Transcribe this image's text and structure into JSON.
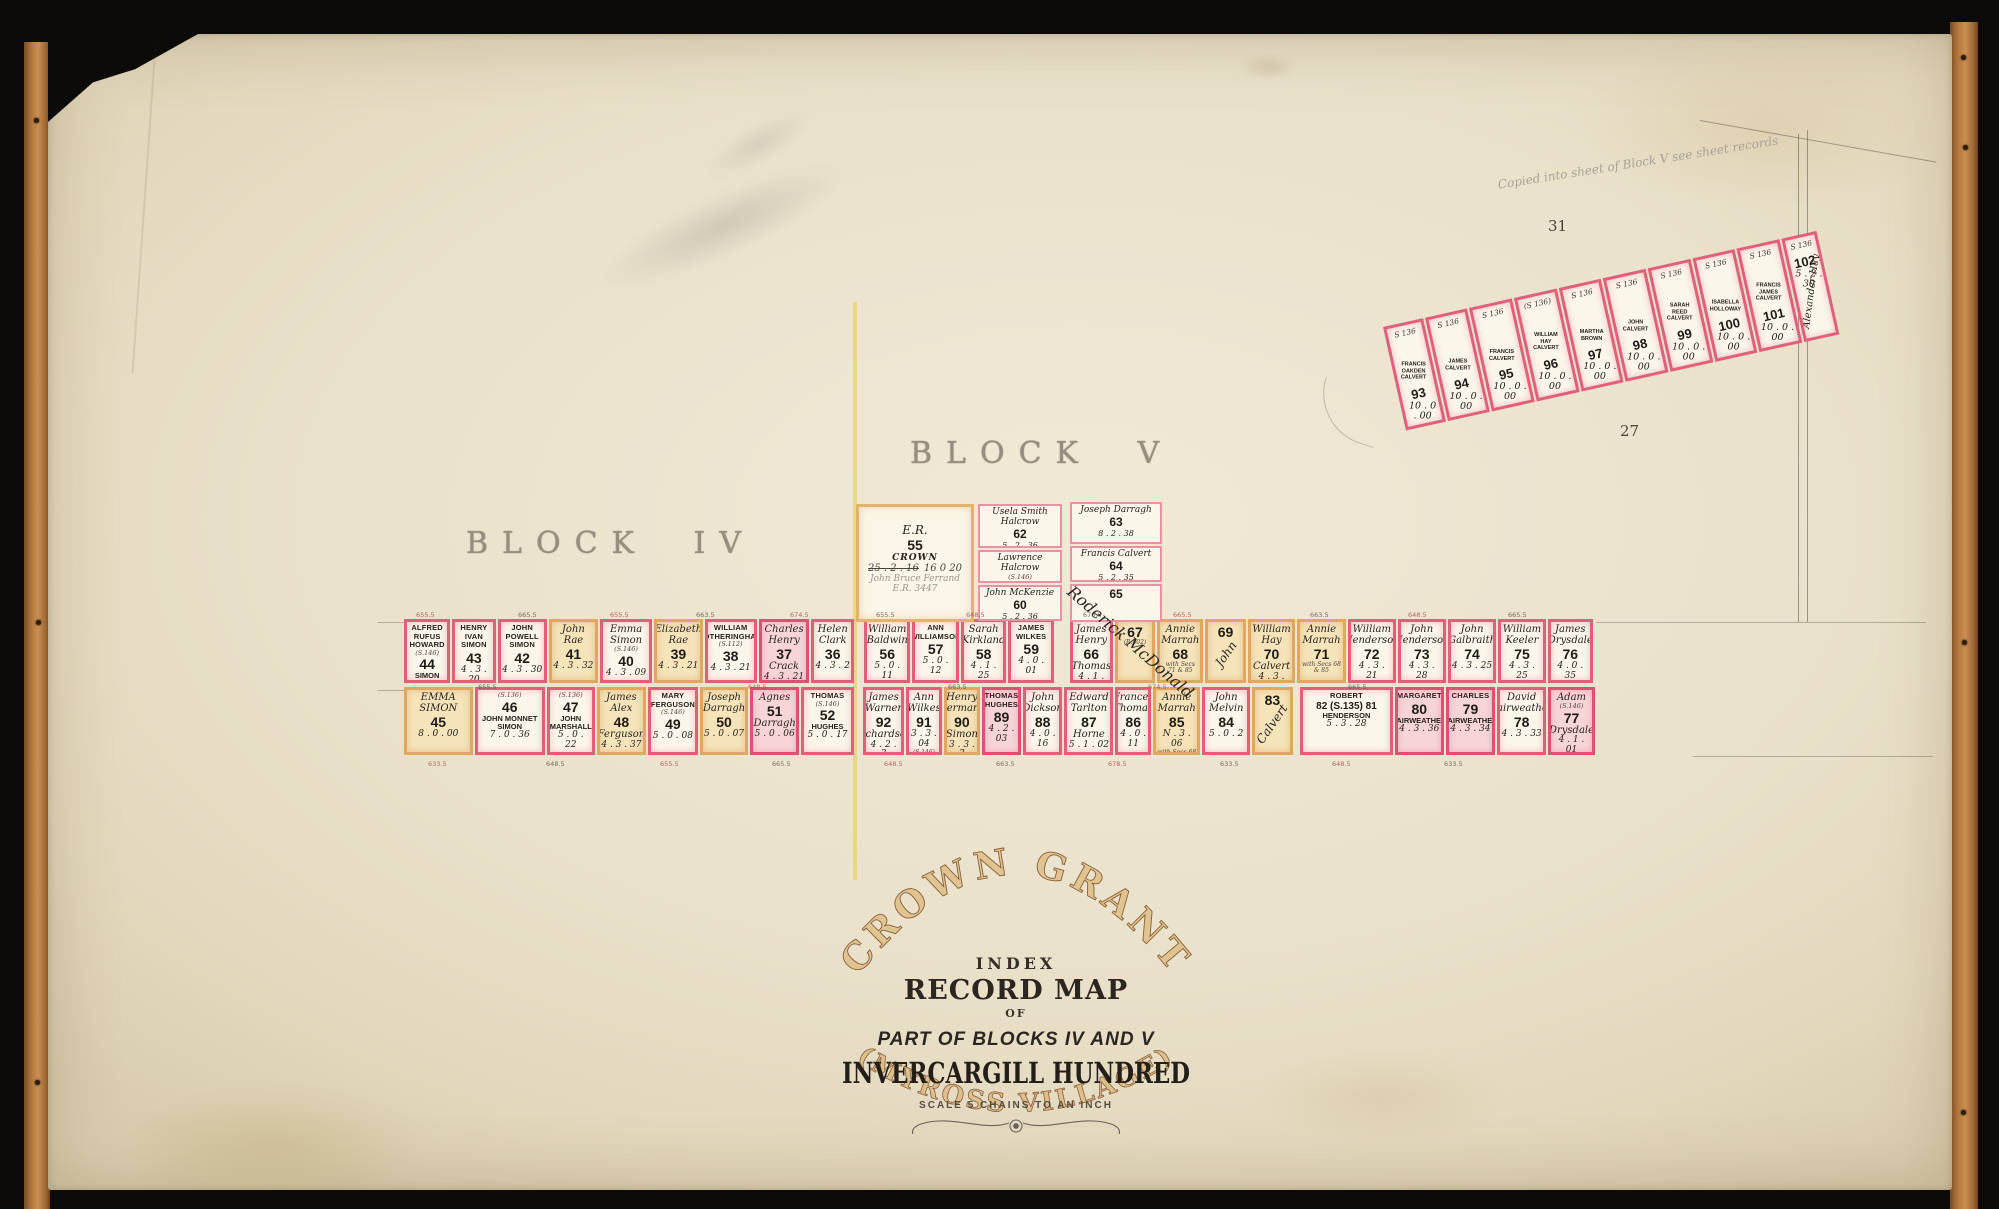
{
  "labels": {
    "block_iv": "BLOCK IV",
    "block_v": "BLOCK V",
    "num_31": "31",
    "num_27": "27",
    "pencil_note": "Copied into sheet of Block V see sheet records",
    "mcdonald": "Roderick McDonald"
  },
  "title": {
    "arc_top": "CROWN GRANT",
    "line1": "INDEX",
    "line2": "RECORD MAP",
    "line3": "OF",
    "line4": "PART OF BLOCKS IV AND V",
    "line5": "INVERCARGILL HUNDRED",
    "scale": "SCALE 5 CHAINS TO AN INCH",
    "arc_bottom": "(MYROSS VILLAGE)"
  },
  "crown_lot": {
    "er": "E.R.",
    "num": "55",
    "crown": "CROWN",
    "crossed": "25 . 2 . 16",
    "revised": "16   0   20",
    "pencil1": "John Bruce Ferrand",
    "pencil2": "E.R. 3447",
    "x": 808,
    "y": 470,
    "w": 118,
    "h": 118
  },
  "block5_upper_lots": [
    {
      "num": "62",
      "name": "Usela Smith Halcrow",
      "ns": "script",
      "area": "5 . 2 . 36",
      "tint": "whitethin",
      "x": 930,
      "y": 470,
      "w": 84,
      "h": 44
    },
    {
      "num": "61",
      "name": "Lawrence Halcrow",
      "ns": "script",
      "note": "(S.146)",
      "area": "5 . 2 . 36",
      "tint": "whitethin",
      "x": 930,
      "y": 516,
      "w": 84,
      "h": 33
    },
    {
      "num": "60",
      "name": "John McKenzie",
      "ns": "script",
      "area": "5 . 2 . 36",
      "tint": "whitethin",
      "x": 930,
      "y": 551,
      "w": 84,
      "h": 36
    },
    {
      "num": "63",
      "name": "Joseph Darragh",
      "ns": "script",
      "area": "8 . 2 . 38",
      "tint": "whitethin",
      "x": 1022,
      "y": 468,
      "w": 92,
      "h": 42
    },
    {
      "num": "64",
      "name": "Francis Calvert",
      "ns": "script",
      "area": "5 . 2 . 35",
      "tint": "whitethin",
      "x": 1022,
      "y": 512,
      "w": 92,
      "h": 36
    },
    {
      "num": "65",
      "tint": "whitethin",
      "x": 1022,
      "y": 550,
      "w": 92,
      "h": 38
    }
  ],
  "row1": {
    "seg_iv": [
      {
        "num": "44",
        "name": "ALFRED RUFUS HOWARD",
        "ns": "caps",
        "note": "(S.146)",
        "name2": "SIMON",
        "n2s": "caps",
        "area": "4 . 3 . 20",
        "tint": "white",
        "w": 52
      },
      {
        "num": "43",
        "name": "HENRY IVAN SIMON",
        "ns": "caps",
        "area": "4 . 3 . 20",
        "tint": "white",
        "w": 48
      },
      {
        "num": "42",
        "name": "JOHN POWELL SIMON",
        "ns": "caps",
        "area": "4 . 3 . 30",
        "tint": "white",
        "w": 56
      },
      {
        "num": "41",
        "name": "John Rae",
        "ns": "script",
        "area": "4 . 3 . 32",
        "tint": "tan",
        "w": 56
      },
      {
        "num": "40",
        "name": "Emma Simon",
        "ns": "script",
        "note": "(S.146)",
        "area": "4 . 3 . 09",
        "tint": "white",
        "w": 60
      },
      {
        "num": "39",
        "name": "Elizabeth Rae",
        "ns": "script",
        "area": "4 . 3 . 21",
        "tint": "tan",
        "w": 55
      },
      {
        "num": "38",
        "name": "WILLIAM FOTHERINGHAM",
        "ns": "caps",
        "note": "(S.112)",
        "area": "4 . 3 . 21",
        "tint": "white",
        "w": 60
      },
      {
        "num": "37",
        "name": "Charles Henry",
        "ns": "script",
        "name2": "Crack",
        "n2s": "script",
        "area": "4 . 3 . 21",
        "tint": "pink",
        "w": 58
      },
      {
        "num": "36",
        "name": "Helen Clark",
        "ns": "script",
        "area": "4 . 3 . 2",
        "tint": "white",
        "w": 47
      }
    ],
    "seg_v1": [
      {
        "num": "56",
        "name": "William Baldwin",
        "ns": "script",
        "area": "5 . 0 . 11",
        "tint": "white",
        "w": 48
      },
      {
        "num": "57",
        "name": "ANN WILLIAMSON",
        "ns": "caps",
        "area": "5 . 0 . 12",
        "tint": "white",
        "w": 48
      },
      {
        "num": "58",
        "name": "Sarah Kirkland",
        "ns": "script",
        "area": "4 . 1 . 25",
        "tint": "white",
        "w": 47
      },
      {
        "num": "59",
        "name": "JAMES WILKES",
        "ns": "caps",
        "area": "4 . 0 . 01",
        "tint": "white",
        "w": 47
      }
    ],
    "seg_v2": [
      {
        "num": "66",
        "name": "James Henry",
        "ns": "script",
        "name2": "Thomas",
        "n2s": "script",
        "area": "4 . 1 . 25",
        "tint": "white",
        "w": 44
      },
      {
        "num": "67",
        "note2": "(R.502)",
        "tint": "tan",
        "w": 42
      },
      {
        "num": "68",
        "name": "Annie Marrah",
        "ns": "script",
        "note2": "with Secs 71 & 85",
        "tint": "tan",
        "w": 48
      },
      {
        "num": "69",
        "diag": "John",
        "tint": "tan",
        "w": 42
      }
    ],
    "seg_v3": [
      {
        "num": "70",
        "name": "William Hay",
        "ns": "script",
        "name2": "Calvert",
        "n2s": "script",
        "area": "4 . 3 . 20",
        "tint": "tan",
        "w": 48
      },
      {
        "num": "71",
        "name": "Annie Marrah",
        "ns": "script",
        "note2": "with Secs 68 & 85",
        "tint": "tan",
        "w": 50
      },
      {
        "num": "72",
        "name": "William Henderson",
        "ns": "script",
        "area": "4 . 3 . 21",
        "tint": "white",
        "w": 49
      },
      {
        "num": "73",
        "name": "John Henderson",
        "ns": "script",
        "area": "4 . 3 . 28",
        "tint": "white",
        "w": 49
      },
      {
        "num": "74",
        "name": "John Galbraith",
        "ns": "script",
        "area": "4 . 3 . 25",
        "tint": "white",
        "w": 50
      },
      {
        "num": "75",
        "name": "William Keeler",
        "ns": "script",
        "note2": "(S.146)",
        "area": "4 . 3 . 25",
        "tint": "white",
        "w": 48
      },
      {
        "num": "76",
        "name": "James Drysdale",
        "ns": "script",
        "area": "4 . 0 . 35",
        "tint": "white",
        "w": 46
      }
    ]
  },
  "row2": {
    "seg_iv": [
      {
        "num": "45",
        "name": "EMMA SIMON",
        "ns": "script",
        "area": "8 . 0 . 00",
        "tint": "tan",
        "w": 70
      },
      {
        "num": "46",
        "note": "(S.136)",
        "name2": "JOHN MONNET SIMON",
        "n2s": "caps",
        "area": "7 . 0 . 36",
        "tint": "white",
        "w": 72
      },
      {
        "num": "47",
        "note": "(S.136)",
        "name2": "JOHN MARSHALL",
        "n2s": "caps",
        "area": "5 . 0 . 22",
        "tint": "white",
        "w": 46
      },
      {
        "num": "48",
        "name": "James Alex",
        "ns": "script",
        "name2": "Ferguson",
        "n2s": "script",
        "area": "4 . 3 . 37",
        "tint": "tan",
        "w": 48
      },
      {
        "num": "49",
        "name": "MARY FERGUSON",
        "ns": "caps",
        "note": "(S.146)",
        "area": "5 . 0 . 08",
        "tint": "white",
        "w": 48
      },
      {
        "num": "50",
        "name": "Joseph Darragh",
        "ns": "script",
        "area": "5 . 0 . 07",
        "tint": "tan",
        "w": 47
      },
      {
        "num": "51",
        "name": "Agnes",
        "ns": "script",
        "name2": "Darragh",
        "n2s": "script",
        "area": "5 . 0 . 06",
        "tint": "pink",
        "w": 47
      },
      {
        "num": "52",
        "name": "THOMAS",
        "ns": "caps",
        "note": "(S.146)",
        "name2": "HUGHES",
        "n2s": "caps",
        "area": "5 . 0 . 17",
        "tint": "white",
        "w": 52
      }
    ],
    "seg_v1": [
      {
        "num": "92",
        "name": "James Warner",
        "ns": "script",
        "name2": "Richardson",
        "n2s": "script",
        "area": "4 . 2 . 3",
        "tint": "white",
        "w": 42
      },
      {
        "num": "91",
        "name": "Ann Wilkes",
        "ns": "script",
        "area": "3 . 3 . 04",
        "note2": "(S.146)",
        "tint": "white",
        "w": 35
      },
      {
        "num": "90",
        "name": "Henry Hermann",
        "ns": "script",
        "name2": "Simon",
        "n2s": "script",
        "area": "3 . 3 . 3",
        "tint": "tan",
        "w": 36
      },
      {
        "num": "89",
        "name": "THOMAS HUGHES",
        "ns": "caps",
        "area": "4 . 2 . 03",
        "tint": "pink",
        "w": 39
      },
      {
        "num": "88",
        "name": "John Dickson",
        "ns": "script",
        "area": "4 . 0 . 16",
        "tint": "white",
        "w": 40
      },
      {
        "num": "87",
        "name": "Edward Tarlton",
        "ns": "script",
        "name2": "Horne",
        "n2s": "script",
        "area": "5 . 1 . 02",
        "tint": "white",
        "w": 52
      },
      {
        "num": "86",
        "name": "Frances Thomas",
        "ns": "script",
        "area": "4 . 0 . 11",
        "tint": "white",
        "w": 35
      },
      {
        "num": "85",
        "name": "Annie Marrah",
        "ns": "script",
        "area": "N . 3 . 06",
        "note2": "with Secs 68 & 71 Block V",
        "tint": "tan",
        "w": 50
      },
      {
        "num": "84",
        "name": "John Melvin",
        "ns": "script",
        "area": "5 . 0 . 2",
        "tint": "white",
        "w": 50
      },
      {
        "num": "83",
        "diag": "Calvert",
        "tint": "tan",
        "w": 42
      }
    ],
    "seg_v2": [
      {
        "num": "82 (S.135) 81",
        "numSmall": true,
        "name": "ROBERT",
        "ns": "caps",
        "name2": "HENDERSON",
        "n2s": "caps",
        "area": "5 . 3 . 28",
        "tint": "white",
        "w": 98
      },
      {
        "num": "80",
        "name": "MARGARET",
        "ns": "caps",
        "name2": "FAIRWEATHER",
        "n2s": "caps",
        "area": "4 . 3 . 36",
        "tint": "pink",
        "w": 47
      },
      {
        "num": "79",
        "name": "CHARLES",
        "ns": "caps",
        "name2": "FAIRWEATHER",
        "n2s": "caps",
        "area": "4 . 3 . 34",
        "tint": "pink",
        "w": 48
      },
      {
        "num": "78",
        "name": "David Fairweather",
        "ns": "script",
        "area": "4 . 3 . 33",
        "tint": "white",
        "w": 47
      },
      {
        "num": "77",
        "name": "Adam",
        "ns": "script",
        "name2": "Drysdale",
        "n2s": "script",
        "note": "(S.146)",
        "area": "4 . 1 . 01",
        "tint": "pink",
        "w": 45
      }
    ]
  },
  "strip": {
    "lots": [
      {
        "num": "93",
        "sec": "S 136",
        "name": "FRANCIS OAKDEN CALVERT",
        "area": "10 . 0 . 00",
        "w": 42
      },
      {
        "num": "94",
        "sec": "S 136",
        "name": "JAMES CALVERT",
        "area": "10 . 0 . 00",
        "w": 46
      },
      {
        "num": "95",
        "sec": "S 136",
        "name": "FRANCIS CALVERT",
        "area": "10 . 0 . 00",
        "w": 46
      },
      {
        "num": "96",
        "sec": "(S 136)",
        "name": "WILLIAM HAY CALVERT",
        "area": "10 . 0 . 00",
        "w": 46
      },
      {
        "num": "97",
        "sec": "S 136",
        "name": "MARTHA BROWN",
        "area": "10 . 0 . 00",
        "w": 46
      },
      {
        "num": "98",
        "sec": "S 136",
        "name": "JOHN CALVERT",
        "area": "10 . 0 . 00",
        "w": 46
      },
      {
        "num": "99",
        "sec": "S 136",
        "name": "SARAH REED CALVERT",
        "area": "10 . 0 . 00",
        "w": 46
      },
      {
        "num": "100",
        "sec": "S 136",
        "name": "ISABELLA HOLLOWAY",
        "area": "10 . 0 . 00",
        "w": 46
      },
      {
        "num": "101",
        "sec": "S 136",
        "name": "FRANCIS JAMES CALVERT",
        "area": "10 . 0 . 00",
        "w": 46
      },
      {
        "num": "102",
        "sec": "S 136",
        "diag": "Alexander Hay",
        "area": "5 . 2 . 30",
        "w": 36
      }
    ]
  },
  "ticks": [
    {
      "t": "655.5",
      "x": 368,
      "y": 577,
      "c": "r"
    },
    {
      "t": "665.5",
      "x": 470,
      "y": 577,
      "c": "k"
    },
    {
      "t": "655.5",
      "x": 562,
      "y": 577,
      "c": "r"
    },
    {
      "t": "663.5",
      "x": 648,
      "y": 577,
      "c": "k"
    },
    {
      "t": "674.5",
      "x": 742,
      "y": 577,
      "c": "r"
    },
    {
      "t": "655.5",
      "x": 828,
      "y": 577,
      "c": "k"
    },
    {
      "t": "648.5",
      "x": 918,
      "y": 577,
      "c": "r"
    },
    {
      "t": "676.5",
      "x": 1035,
      "y": 577,
      "c": "k"
    },
    {
      "t": "665.5",
      "x": 1125,
      "y": 577,
      "c": "r"
    },
    {
      "t": "663.5",
      "x": 1262,
      "y": 577,
      "c": "k"
    },
    {
      "t": "648.5",
      "x": 1360,
      "y": 577,
      "c": "r"
    },
    {
      "t": "665.5",
      "x": 1460,
      "y": 577,
      "c": "k"
    },
    {
      "t": "655.5",
      "x": 430,
      "y": 649,
      "c": "k"
    },
    {
      "t": "648.5",
      "x": 700,
      "y": 649,
      "c": "r"
    },
    {
      "t": "663.5",
      "x": 900,
      "y": 649,
      "c": "k"
    },
    {
      "t": "674.5",
      "x": 1100,
      "y": 649,
      "c": "r"
    },
    {
      "t": "665.5",
      "x": 1300,
      "y": 649,
      "c": "k"
    },
    {
      "t": "633.5",
      "x": 380,
      "y": 726,
      "c": "r"
    },
    {
      "t": "648.5",
      "x": 498,
      "y": 726,
      "c": "k"
    },
    {
      "t": "655.5",
      "x": 612,
      "y": 726,
      "c": "r"
    },
    {
      "t": "665.5",
      "x": 724,
      "y": 726,
      "c": "k"
    },
    {
      "t": "648.5",
      "x": 836,
      "y": 726,
      "c": "r"
    },
    {
      "t": "663.5",
      "x": 948,
      "y": 726,
      "c": "k"
    },
    {
      "t": "678.5",
      "x": 1060,
      "y": 726,
      "c": "r"
    },
    {
      "t": "633.5",
      "x": 1172,
      "y": 726,
      "c": "k"
    },
    {
      "t": "648.5",
      "x": 1284,
      "y": 726,
      "c": "r"
    },
    {
      "t": "633.5",
      "x": 1396,
      "y": 726,
      "c": "k"
    }
  ]
}
